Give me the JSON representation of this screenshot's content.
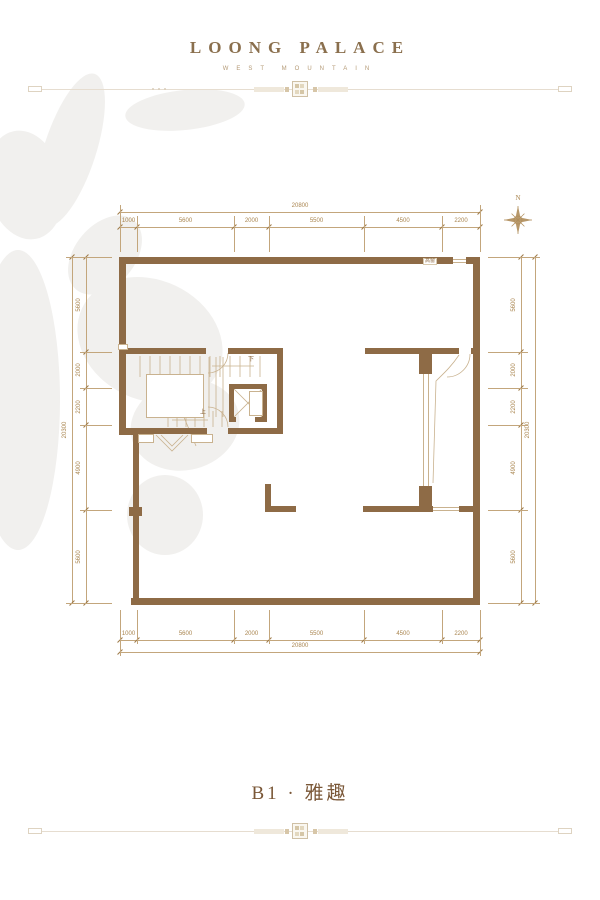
{
  "header": {
    "title": "LOONG PALACE",
    "subtitle": "WEST MOUNTAIN"
  },
  "compass": {
    "north_label": "N"
  },
  "plan_labels": {
    "high_window": "高窗",
    "stair_down": "下",
    "stair_up": "上"
  },
  "title": {
    "text": "B1 · 雅趣"
  },
  "dimensions": {
    "top": {
      "total": "20800",
      "segments": [
        "1000",
        "5600",
        "2000",
        "5500",
        "4500",
        "2200"
      ]
    },
    "bottom": {
      "total": "20800",
      "segments": [
        "1000",
        "5600",
        "2000",
        "5500",
        "4500",
        "2200"
      ]
    },
    "left": {
      "total": "20300",
      "segments": [
        "5600",
        "2000",
        "2200",
        "4900",
        "5600"
      ]
    },
    "right": {
      "total": "20300",
      "segments": [
        "5600",
        "2000",
        "2200",
        "4900",
        "5600"
      ]
    }
  },
  "colors": {
    "wall": "#8e6b46",
    "dim_line": "#c3a67c",
    "dim_text": "#a9854f",
    "accent": "#8a6f4d",
    "title_text": "#7a5737",
    "thin_line": "#c9b28f",
    "divider": "#e6ddd0"
  }
}
